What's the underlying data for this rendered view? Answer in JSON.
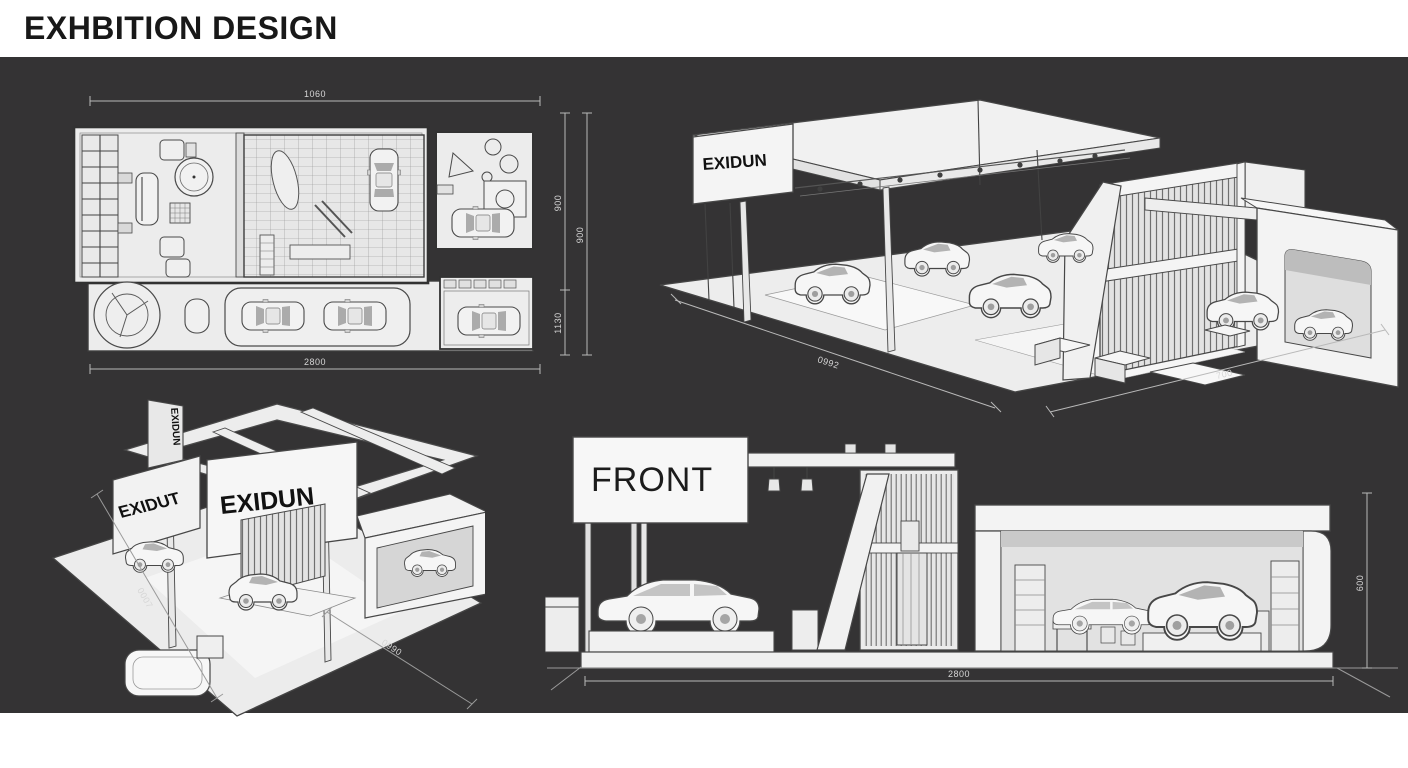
{
  "page": {
    "title": "EXHBITION DESIGN",
    "background_dark": "#343334",
    "background_light": "#ffffff"
  },
  "drawings": {
    "floor_plan": {
      "dim_top": "1060",
      "dim_bottom": "2800",
      "dim_right_outer": "900",
      "dim_right_inner_top": "900",
      "dim_right_inner_bottom": "1130"
    },
    "iso_view_right": {
      "sign": "EXIDUN",
      "dim_left": "0992",
      "dim_right": "700"
    },
    "iso_view_left": {
      "sign_front": "EXIDUN",
      "sign_side": "EXIDUT",
      "sign_vertical": "EXIDUN",
      "dim_left": "0007",
      "dim_bottom": "0990"
    },
    "front_view": {
      "label": "FRONT",
      "dim_bottom": "2800",
      "dim_right": "600"
    }
  }
}
